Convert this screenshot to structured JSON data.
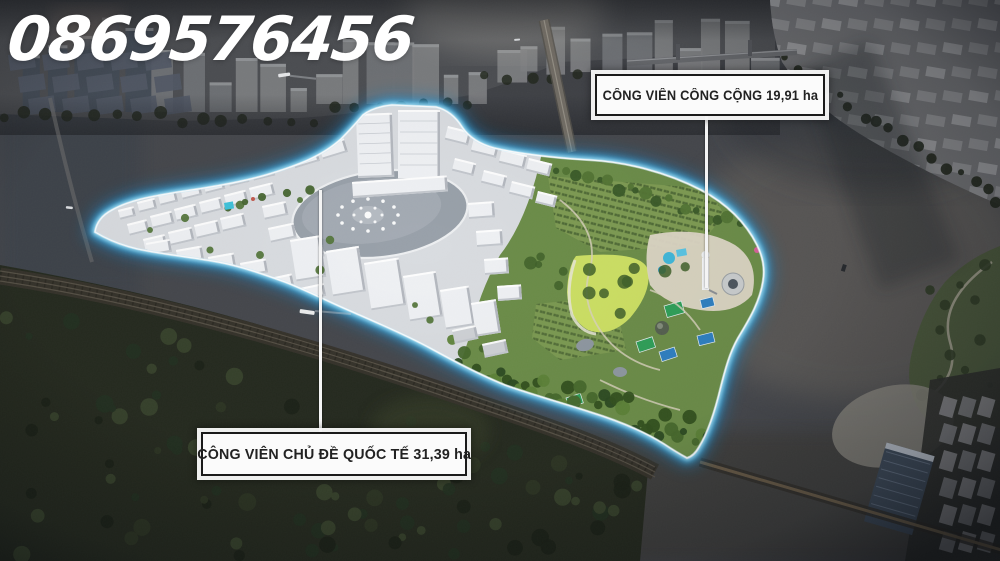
{
  "watermark": "0869576456",
  "callouts": {
    "public_park": {
      "label": "CÔNG VIÊN CÔNG CỘNG 19,91 ha"
    },
    "theme_park": {
      "label": "CÔNG VIÊN CHỦ ĐỀ QUỐC TẾ 31,39 ha"
    }
  },
  "colors": {
    "island_glow": "#52c8f5",
    "water_dark": "#45474c",
    "park_green": "#6b8c48",
    "lawn_green": "#ccdf63",
    "label_bg": "#fbfbfb",
    "label_border": "#1a1a1a",
    "label_text": "#222222",
    "watermark_text": "#ffffff"
  }
}
